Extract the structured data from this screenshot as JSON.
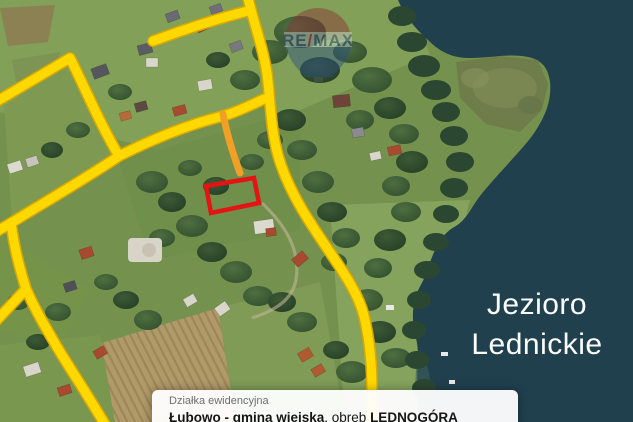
{
  "map_overlay": {
    "lake_label_line1": "Jezioro",
    "lake_label_line2": "Lednickie"
  },
  "watermark": {
    "brand_re": "RE",
    "brand_slash": "/",
    "brand_max": "MAX"
  },
  "info_panel": {
    "caption": "Działka ewidencyjna",
    "municipality_bold": "Łubowo - gmina wiejska",
    "separator": ", obręb ",
    "district_bold": "LEDNOGÓRA"
  },
  "colors": {
    "road_highlight": "#ffd800",
    "road_casing": "#d9a800",
    "access_road": "#f0a125",
    "parcel_outline": "#e31414",
    "water": "#20404d"
  }
}
